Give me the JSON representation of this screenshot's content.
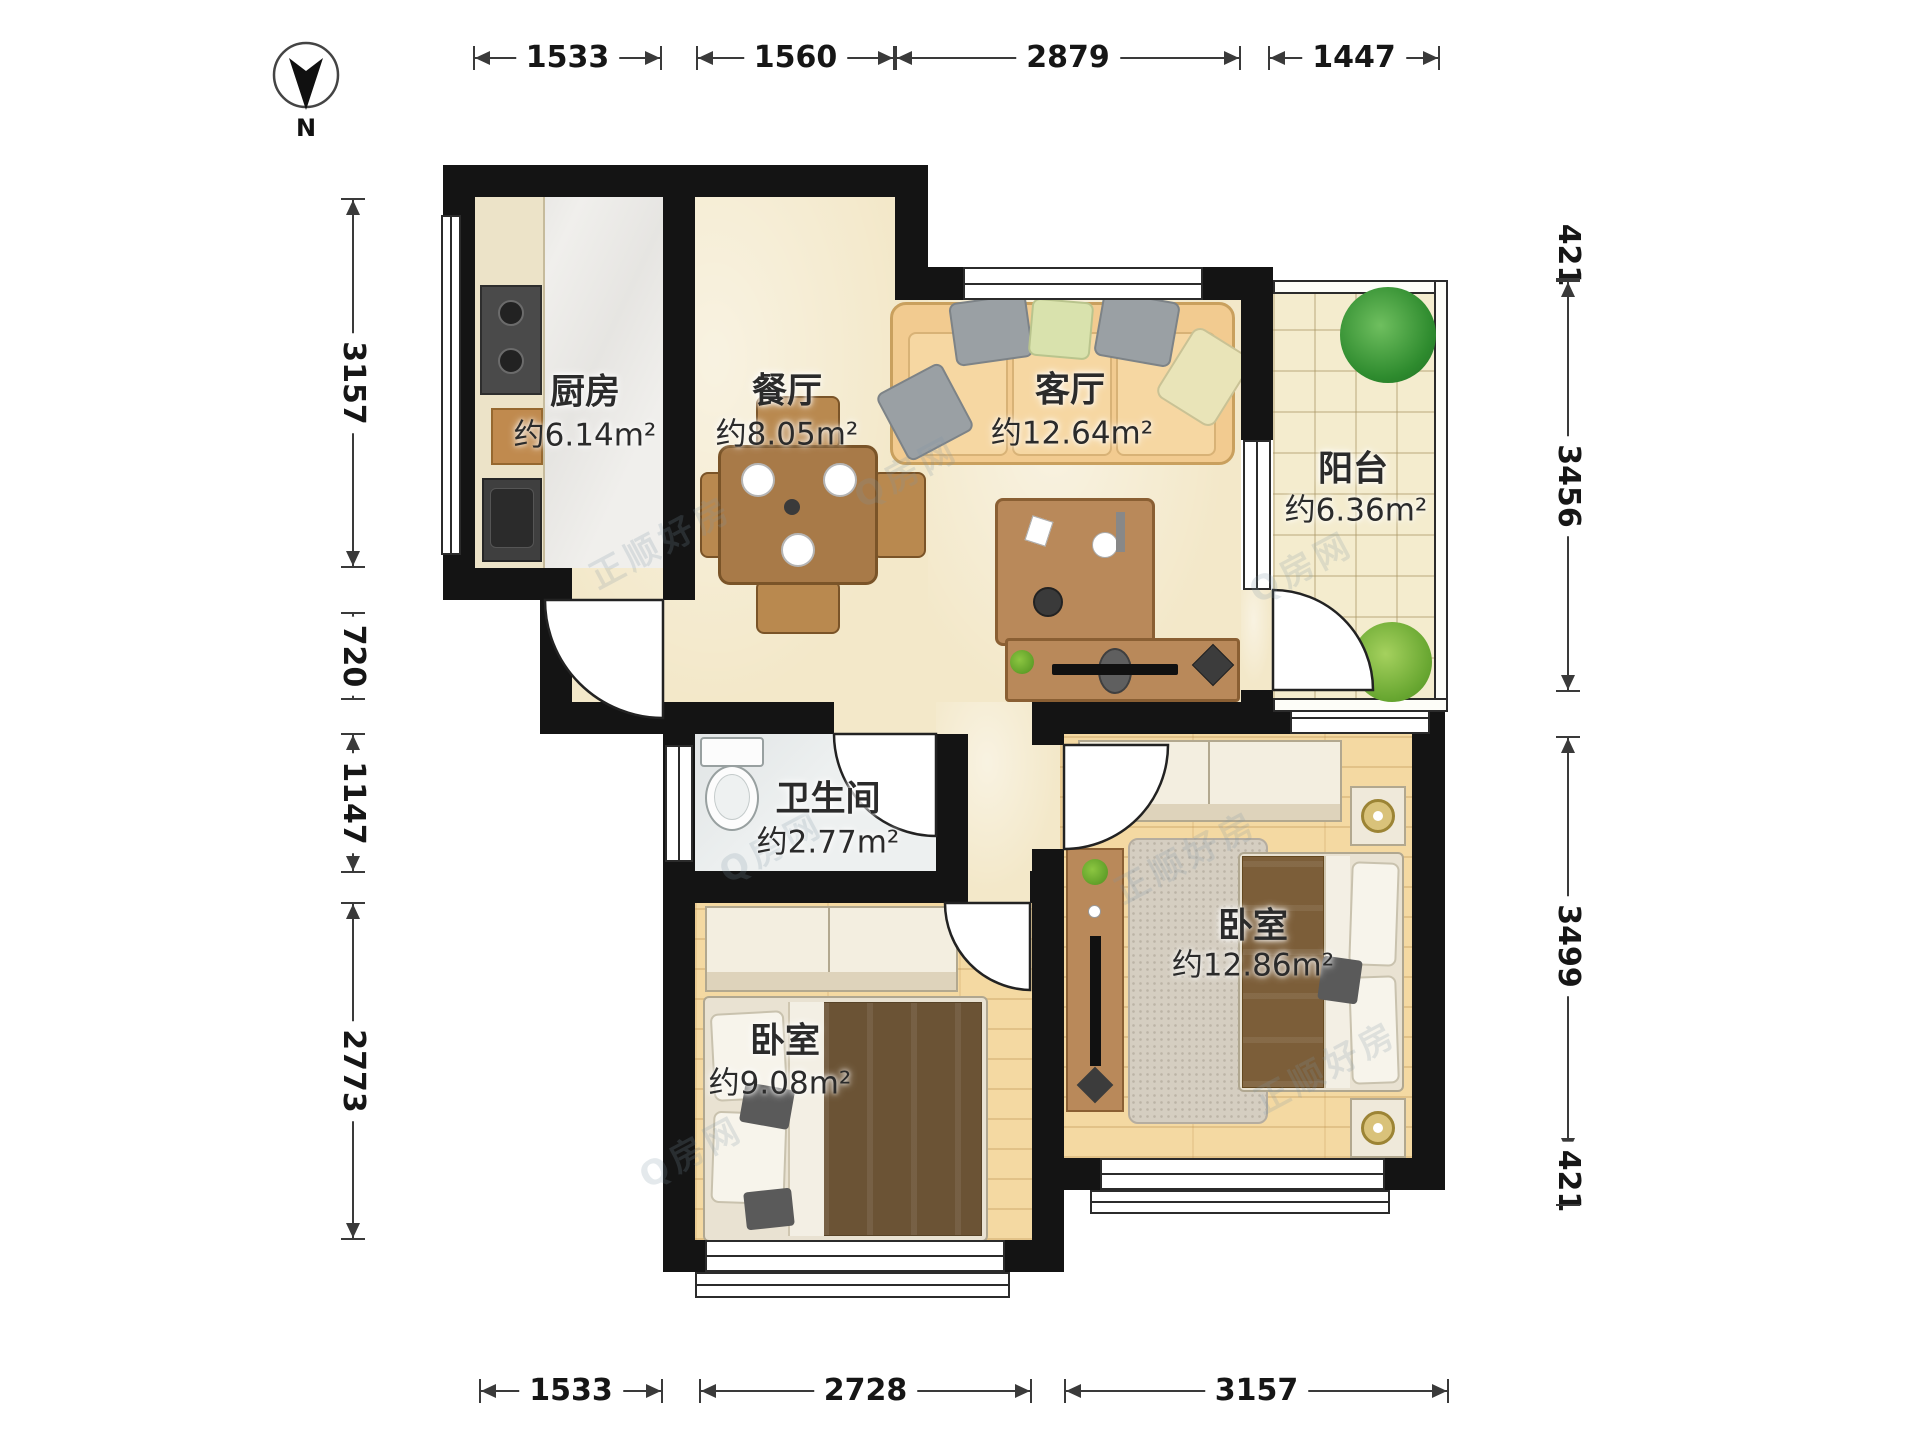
{
  "compass": {
    "label": "N"
  },
  "rooms": {
    "kitchen": {
      "name": "厨房",
      "area": "约6.14m²"
    },
    "dining": {
      "name": "餐厅",
      "area": "约8.05m²"
    },
    "living": {
      "name": "客厅",
      "area": "约12.64m²"
    },
    "balcony": {
      "name": "阳台",
      "area": "约6.36m²"
    },
    "bathroom": {
      "name": "卫生间",
      "area": "约2.77m²"
    },
    "bedroom_small": {
      "name": "卧室",
      "area": "约9.08m²"
    },
    "bedroom_large": {
      "name": "卧室",
      "area": "约12.86m²"
    }
  },
  "dimensions": {
    "top": [
      "1533",
      "1560",
      "2879",
      "1447"
    ],
    "left": [
      "3157",
      "720",
      "1147",
      "2773"
    ],
    "right": [
      "421",
      "3456",
      "3499",
      "421"
    ],
    "bottom": [
      "1533",
      "2728",
      "3157"
    ]
  },
  "watermark": {
    "brand": "正顺好房",
    "site": "Q房网"
  },
  "colors": {
    "wall": "#141414",
    "main_floor": "#f3e8c9",
    "wood_floor": "#f4d9a2",
    "kitchen_floor": "#f0efec",
    "balcony_floor": "#f4ecce",
    "furniture_wood": "#b9895a",
    "sofa": "#f2cb90"
  }
}
